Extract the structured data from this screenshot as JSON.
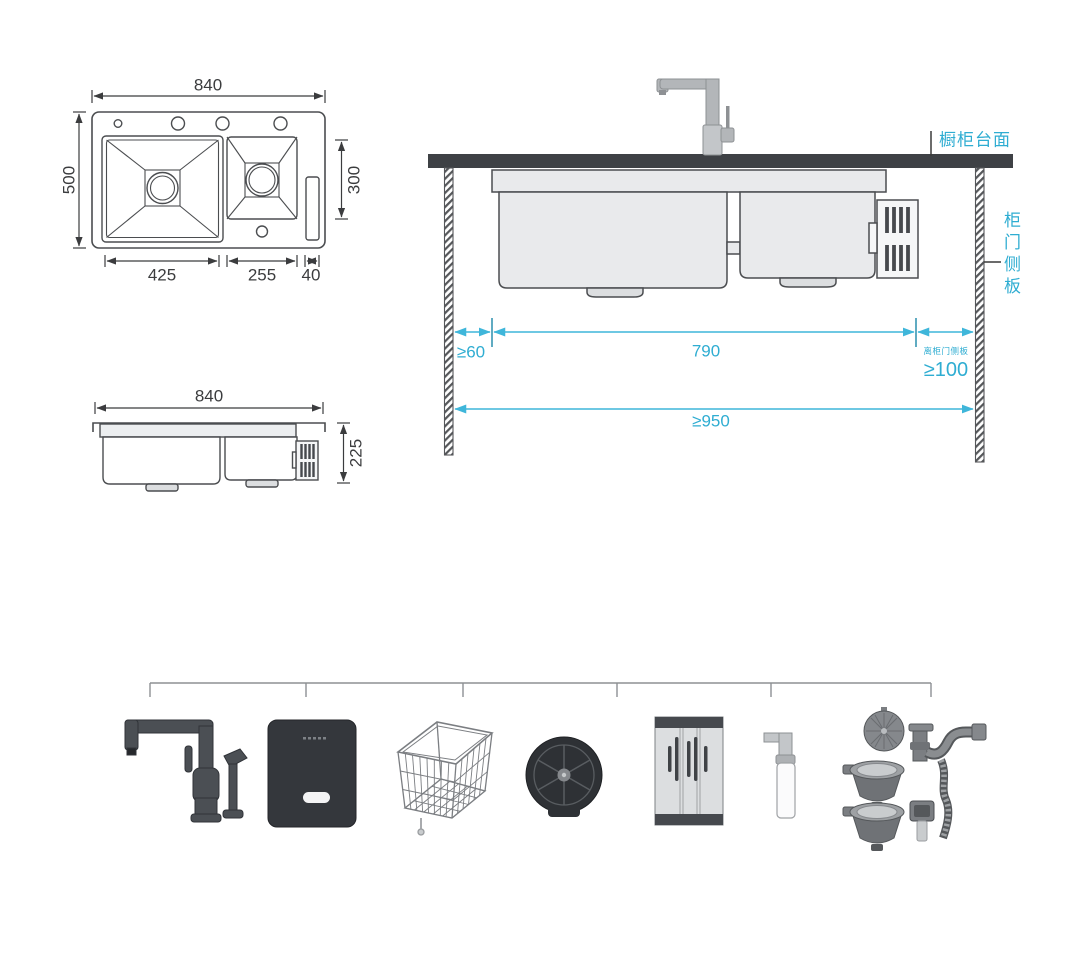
{
  "colors": {
    "accent_cyan": "#2fadd2",
    "dim_line_cyan": "#3fb6da",
    "drawing_line": "#4b4d50",
    "dim_text": "#3b3c3e",
    "countertop": "#3e4145",
    "sink_fill": "#e9eaec"
  },
  "plan_view": {
    "overall_width": "840",
    "overall_depth": "500",
    "right_bowl_depth": "300",
    "left_bowl_width": "425",
    "right_bowl_width": "255",
    "tray_width": "40"
  },
  "side_view": {
    "overall_width": "840",
    "overall_height": "225"
  },
  "section_view": {
    "countertop_label": "橱柜台面",
    "cabinet_side_panel_label": "柜门侧板",
    "min_left_clearance": "≥60",
    "cabinet_opening_width": "790",
    "min_right_clearance": "≥100",
    "min_right_clearance_note": "离柜门侧板",
    "min_cabinet_width": "≥950"
  },
  "accessories": {
    "items": [
      {
        "name": "pull-out-kitchen-faucet"
      },
      {
        "name": "black-control-panel"
      },
      {
        "name": "stainless-drain-basket"
      },
      {
        "name": "cup-rinser"
      },
      {
        "name": "roll-up-drain-rack"
      },
      {
        "name": "soap-dispenser"
      },
      {
        "name": "drain-pipe-assembly"
      }
    ]
  }
}
